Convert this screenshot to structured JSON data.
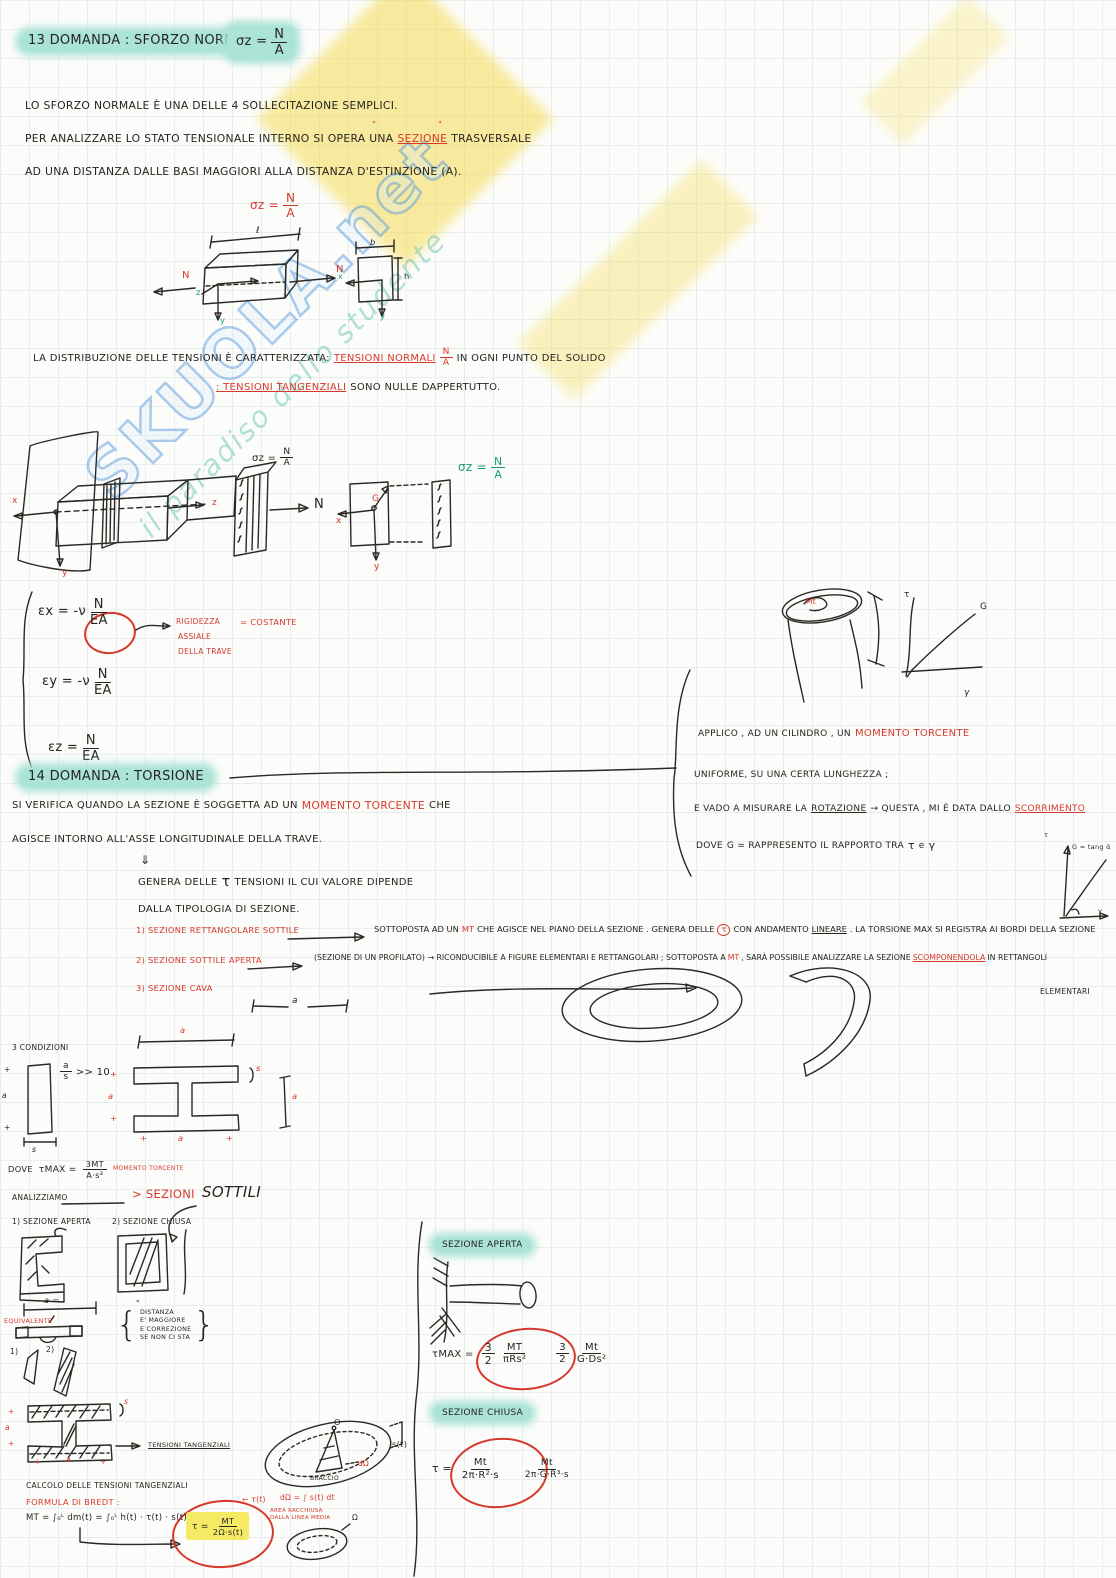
{
  "watermark": {
    "brand": "SKUOLA.net",
    "tagline": "il paradiso dello studente"
  },
  "q13": {
    "title": "13 DOMANDA : SFORZO NORMALE",
    "sigma": "σz =",
    "frac_n": "N",
    "frac_a": "A",
    "p1": "LO SFORZO NORMALE È UNA DELLE 4 SOLLECITAZIONE SEMPLICI.",
    "p2a": "PER ANALIZZARE LO STATO TENSIONALE INTERNO SI OPERA UNA",
    "p2_hl": "SEZIONE",
    "p2b": "TRASVERSALE",
    "quote": "\"",
    "p3": "AD UNA DISTANZA DALLE BASI MAGGIORI ALLA DISTANZA D'ESTINZIONE (A).",
    "beam": {
      "l": "ℓ",
      "n_left": "N",
      "n_right": "N",
      "z": "z",
      "y": "y",
      "b": "b",
      "h": "h",
      "x": "x",
      "y2": "y"
    },
    "dist1a": "LA DISTRIBUZIONE DELLE TENSIONI È CARATTERIZZATA:",
    "dist1_red": "TENSIONI NORMALI",
    "dist1b": "IN OGNI PUNTO DEL SOLIDO",
    "dist2_red": ": TENSIONI TANGENZIALI",
    "dist2b": "SONO NULLE DAPPERTUTTO.",
    "diag": {
      "x": "x",
      "y": "y",
      "z": "z",
      "sigma": "σz =",
      "n": "N",
      "x2": "x",
      "y2": "y",
      "g": "G"
    },
    "eq1_lhs": "εx = -ν",
    "eq2_lhs": "εy = -ν",
    "eq3_lhs": "εz =",
    "en": "N",
    "ea": "EA",
    "note1": "RIGIDEZZA",
    "note2": "ASSIALE",
    "note3": "DELLA TRAVE",
    "note_eq": "= COSTANTE"
  },
  "q14": {
    "title": "14 DOMANDA : TORSIONE",
    "p1a": "SI VERIFICA QUANDO LA SEZIONE È SOGGETTA AD UN",
    "p1_red": "MOMENTO TORCENTE",
    "p1b": "CHE",
    "p2": "AGISCE INTORNO ALL'ASSE LONGITUDINALE DELLA TRAVE.",
    "darr": "⇓",
    "p3a": "GENERA DELLE",
    "p3_tau": "τ",
    "p3b": "TENSIONI   IL CUI VALORE DIPENDE",
    "p4": "DALLA TIPOLOGIA DI SEZIONE.",
    "right": {
      "r1a": "APPLICO , AD UN  CILINDRO , UN",
      "r1_red": "MOMENTO TORCENTE",
      "r2": "UNIFORME,  SU  UNA   CERTA   LUNGHEZZA ;",
      "r3a": "E VADO  A  MISURARE  LA",
      "r3_u": "ROTAZIONE",
      "r3b": "→ QUESTA , MI È DATA   DALLO",
      "r3_red": "SCORRIMENTO",
      "r4a": "DOVE",
      "r4b": "G = RAPPRESENTO  IL RAPPORTO TRA",
      "r4_tau": "τ",
      "r4c": "e",
      "r4_gamma": "γ",
      "mini": {
        "tau": "τ",
        "gamma": "γ",
        "eq": "G = tang ᾱ"
      },
      "cyl": {
        "mt": "Mt",
        "tau": "τ",
        "g": "G",
        "gamma": "γ"
      }
    },
    "it1": {
      "label": "1) SEZIONE RETTANGOLARE SOTTILE",
      "d1": "SOTTOPOSTA AD UN",
      "mt": "MT",
      "d2": "CHE AGISCE NEL PIANO DELLA SEZIONE . GENERA DELLE",
      "tau": "τ",
      "d3": "CON ANDAMENTO",
      "lin": "LINEARE",
      "d4": ". LA TORSIONE MAX SI REGISTRA AI BORDI DELLA SEZIONE"
    },
    "it2": {
      "label": "2) SEZIONE SOTTILE APERTA",
      "d1": "(SEZIONE DI UN PROFILATO) → RICONDUCIBILE A FIGURE ELEMENTARI E RETTANGOLARI ; SOTTOPOSTA A",
      "mt": "MT",
      "d2": ", SARÀ POSSIBILE ANALIZZARE LA SEZIONE",
      "red": "SCOMPONENDOLA",
      "d3": "IN RETTANGOLI",
      "cont": "ELEMENTARI"
    },
    "it3": {
      "label": "3) SEZIONE CAVA"
    },
    "dim_a": "a",
    "cond": {
      "title": "3 CONDIZIONI",
      "ra": "a",
      "rs": "s",
      "rr": ">> 10",
      "plus": "+",
      "a": "a",
      "s": "s"
    },
    "dove": {
      "lbl": "DOVE",
      "t": "τMAX =",
      "n": "3MT",
      "d": "A·s²",
      "note": "MOMENTO TORCENTE"
    },
    "ana": {
      "lbl": "ANALIZZIAMO",
      "red": "> SEZIONI",
      "big": "SOTTILI"
    },
    "sub1": "1) SEZIONE APERTA",
    "sub2": "2) SEZIONE CHIUSA",
    "equiv": "EQUIVALENTE",
    "a_eq": "a =",
    "ditto": "\"",
    "br": {
      "open": "{",
      "close": "}",
      "l1": "DISTANZA",
      "l2": "E' MAGGIORE",
      "l3": "E CORREZIONE",
      "l4": "SE NON CI STA"
    },
    "n1": "1)",
    "n2": "2)",
    "tt": "TENSIONI TANGENZIALI",
    "calc": "CALCOLO DELLE TENSIONI TANGENZIALI",
    "bredt_lbl": "FORMULA DI BREDT :",
    "bredt_f": "MT = ∫₀ᴸ dm(t) = ∫₀ᴸ h(t) · τ(t) · s(t) dt",
    "res": {
      "t": "τ =",
      "n": "MT",
      "d": "2Ω·s(t)",
      "note": "← τ(t)"
    },
    "domega": "dΩ = ∫ s(t) dt",
    "area_note": "AREA RACCHIUSA DALLA LINEA MEDIA",
    "om": "Ω",
    "ap": {
      "title": "SEZIONE APERTA",
      "t": "τMAX =",
      "an": "3",
      "ad": "2",
      "bn": "MT",
      "bd": "πRs²",
      "cn": "3",
      "cd": "2",
      "dn": "Mt",
      "dd": "G·Ds²"
    },
    "ch": {
      "title": "SEZIONE CHIUSA",
      "t": "τ =",
      "an": "Mt",
      "ad": "2π·R²·s",
      "bn": "Mt",
      "bd": "2π·G·R³·s"
    },
    "ell": {
      "o": "O",
      "st": "s(t)",
      "dom": "dΩ",
      "braccio": "BRACCIO"
    }
  }
}
